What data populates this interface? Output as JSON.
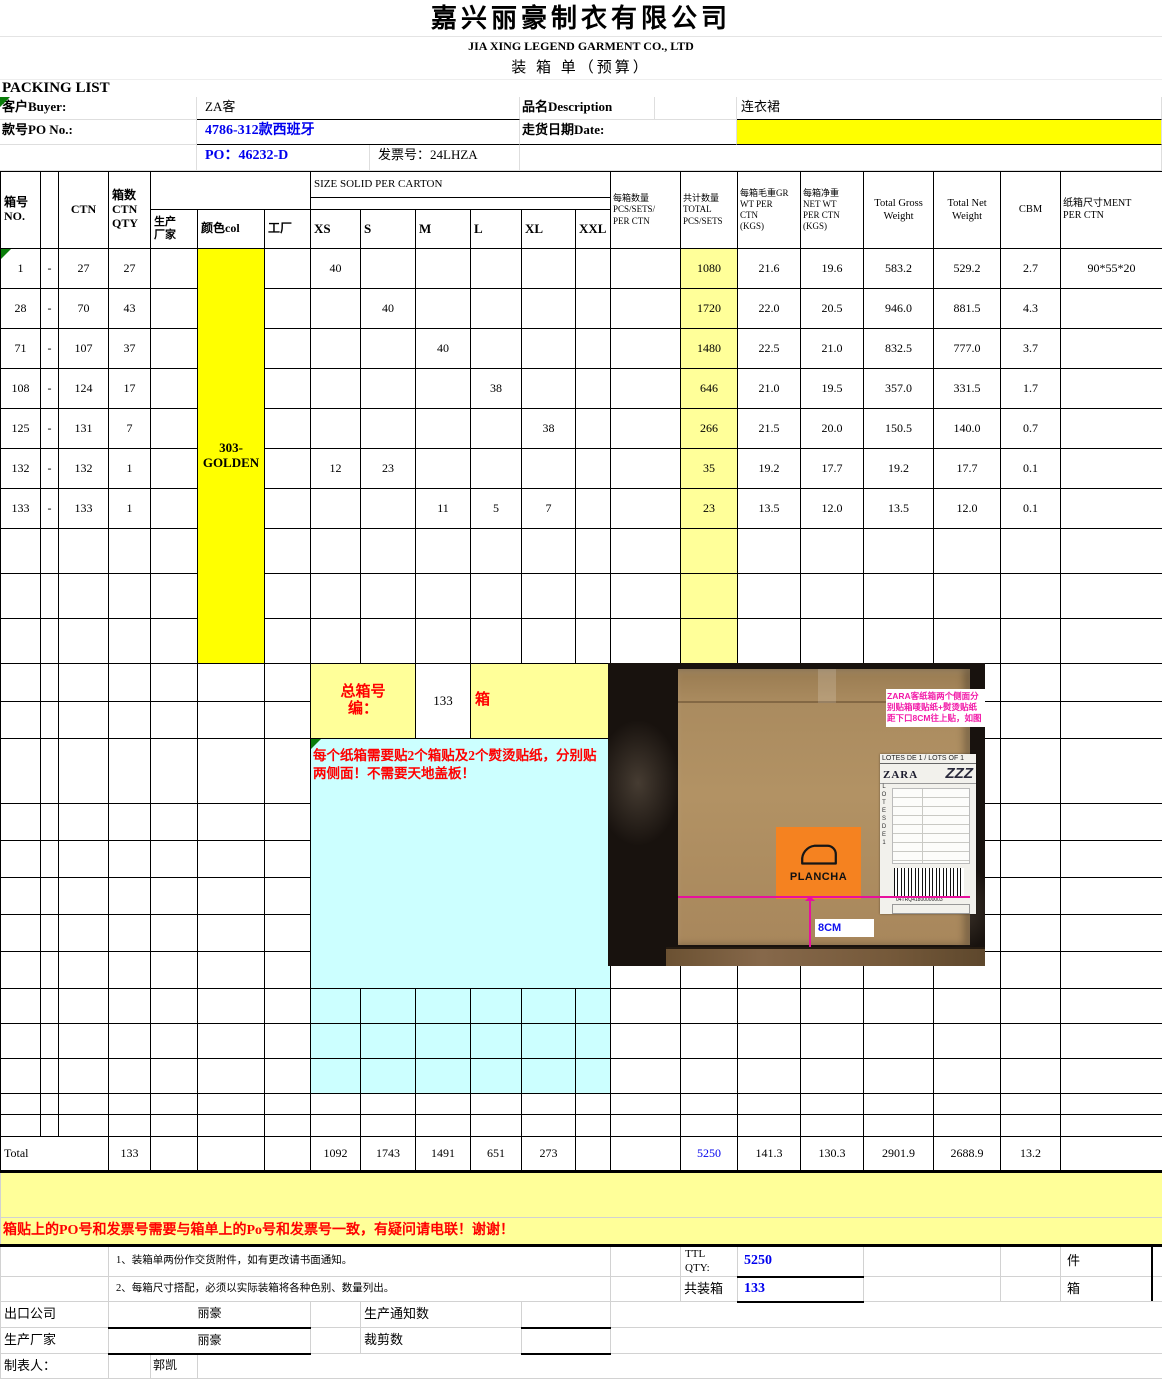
{
  "company": {
    "name_zh": "嘉兴丽豪制衣有限公司",
    "name_en": "JIA XING LEGEND GARMENT CO., LTD",
    "doc_title": "装  箱  单（预算）",
    "packing_list": "PACKING    LIST"
  },
  "info": {
    "buyer_label": "客户Buyer:",
    "buyer": "ZA客",
    "desc_label": "品名Description",
    "desc": "连衣裙",
    "po_label": "款号PO No.:",
    "po_style": "4786-312款西班牙",
    "date_label": "走货日期Date:",
    "date_value": "",
    "po_number": "PO：46232-D",
    "invoice": "发票号：24LHZA"
  },
  "table": {
    "headers": {
      "no": "箱号\nNO.",
      "ctn": "CTN",
      "qty": "箱数\nCTN\nQTY",
      "factory": "生产\n厂家",
      "color": "颜色col",
      "plant": "工厂",
      "size_banner": "SIZE SOLID PER CARTON",
      "sizes": [
        "XS",
        "S",
        "M",
        "L",
        "XL",
        "XXL"
      ],
      "per_ctn": "每箱数量\nPCS/SETS/\nPER CTN",
      "total": "共计数量\nTOTAL\nPCS/SETS",
      "gw": "每箱毛重GR\nWT PER\nCTN\n(KGS)",
      "nw": "每箱净重\nNET WT\nPER CTN\n(KGS)",
      "tgw": "Total Gross\nWeight",
      "tnw": "Total Net\nWeight",
      "cbm": "CBM",
      "dim": "纸箱尺寸MENT\nPER CTN"
    },
    "color_value": "303-GOLDEN",
    "rows": [
      {
        "from": "1",
        "dash": "-",
        "to": "27",
        "qty": "27",
        "xs": "40",
        "total": "1080",
        "gw": "21.6",
        "nw": "19.6",
        "tgw": "583.2",
        "tnw": "529.2",
        "cbm": "2.7",
        "dim": "90*55*20"
      },
      {
        "from": "28",
        "dash": "-",
        "to": "70",
        "qty": "43",
        "s": "40",
        "total": "1720",
        "gw": "22.0",
        "nw": "20.5",
        "tgw": "946.0",
        "tnw": "881.5",
        "cbm": "4.3"
      },
      {
        "from": "71",
        "dash": "-",
        "to": "107",
        "qty": "37",
        "m": "40",
        "total": "1480",
        "gw": "22.5",
        "nw": "21.0",
        "tgw": "832.5",
        "tnw": "777.0",
        "cbm": "3.7"
      },
      {
        "from": "108",
        "dash": "-",
        "to": "124",
        "qty": "17",
        "l": "38",
        "total": "646",
        "gw": "21.0",
        "nw": "19.5",
        "tgw": "357.0",
        "tnw": "331.5",
        "cbm": "1.7"
      },
      {
        "from": "125",
        "dash": "-",
        "to": "131",
        "qty": "7",
        "xl": "38",
        "total": "266",
        "gw": "21.5",
        "nw": "20.0",
        "tgw": "150.5",
        "tnw": "140.0",
        "cbm": "0.7"
      },
      {
        "from": "132",
        "dash": "-",
        "to": "132",
        "qty": "1",
        "xs": "12",
        "s": "23",
        "total": "35",
        "gw": "19.2",
        "nw": "17.7",
        "tgw": "19.2",
        "tnw": "17.7",
        "cbm": "0.1"
      },
      {
        "from": "133",
        "dash": "-",
        "to": "133",
        "qty": "1",
        "m": "11",
        "l": "5",
        "xl": "7",
        "total": "23",
        "gw": "13.5",
        "nw": "12.0",
        "tgw": "13.5",
        "tnw": "12.0",
        "cbm": "0.1"
      }
    ],
    "total_row": {
      "label": "Total",
      "qty": "133",
      "xs": "1092",
      "s": "1743",
      "m": "1491",
      "l": "651",
      "xl": "273",
      "total": "5250",
      "gw": "141.3",
      "nw": "130.3",
      "tgw": "2901.9",
      "tnw": "2688.9",
      "cbm": "13.2"
    }
  },
  "summary": {
    "label": "总箱号\n编：",
    "count": "133",
    "unit": "箱"
  },
  "sticker_note": "每个纸箱需要贴2个箱贴及2个熨烫贴纸，分别贴两侧面！不需要天地盖板！",
  "po_note": "箱贴上的PO号和发票号需要与箱单上的Po号和发票号一致，有疑问请电联！谢谢！",
  "notes": [
    "1、装箱单两份作交货附件，如有更改请书面通知。",
    "2、每箱尺寸搭配，必须以实际装箱将各种色别、数量列出。"
  ],
  "totals_box": {
    "ttl_label": "TTL\nQTY:",
    "ttl_value": "5250",
    "ttl_unit": "件",
    "ctn_label": "共装箱",
    "ctn_value": "133",
    "ctn_unit": "箱"
  },
  "footer": {
    "exporter_label": "出口公司",
    "exporter": "丽豪",
    "producer_label": "生产厂家",
    "producer": "丽豪",
    "notice_label": "生产通知数",
    "cutting_label": "裁剪数",
    "preparer_label": "制表人：",
    "preparer": "郭凯"
  },
  "photo": {
    "annotation": "ZARA客纸箱两个侧面分\n别贴箱唛贴纸+熨烫贴纸\n距下口8CM往上贴，如图",
    "label_header": "LOTES DE 1 / LOTS OF 1",
    "label_side": "LOTESDE1",
    "label_brand": "ZARA",
    "label_zzz": "ZZZ",
    "plancha": "PLANCHA",
    "dim_label": "8CM",
    "barcode_number": "04TRQ41800000003"
  },
  "colors": {
    "bright_yellow": "#ffff00",
    "light_yellow": "#ffff99",
    "cyan": "#ccffff",
    "red_text": "#ff0000",
    "blue_text": "#0000ee",
    "magenta_annotation": "#f21aa8",
    "plancha_orange": "#f58220"
  }
}
